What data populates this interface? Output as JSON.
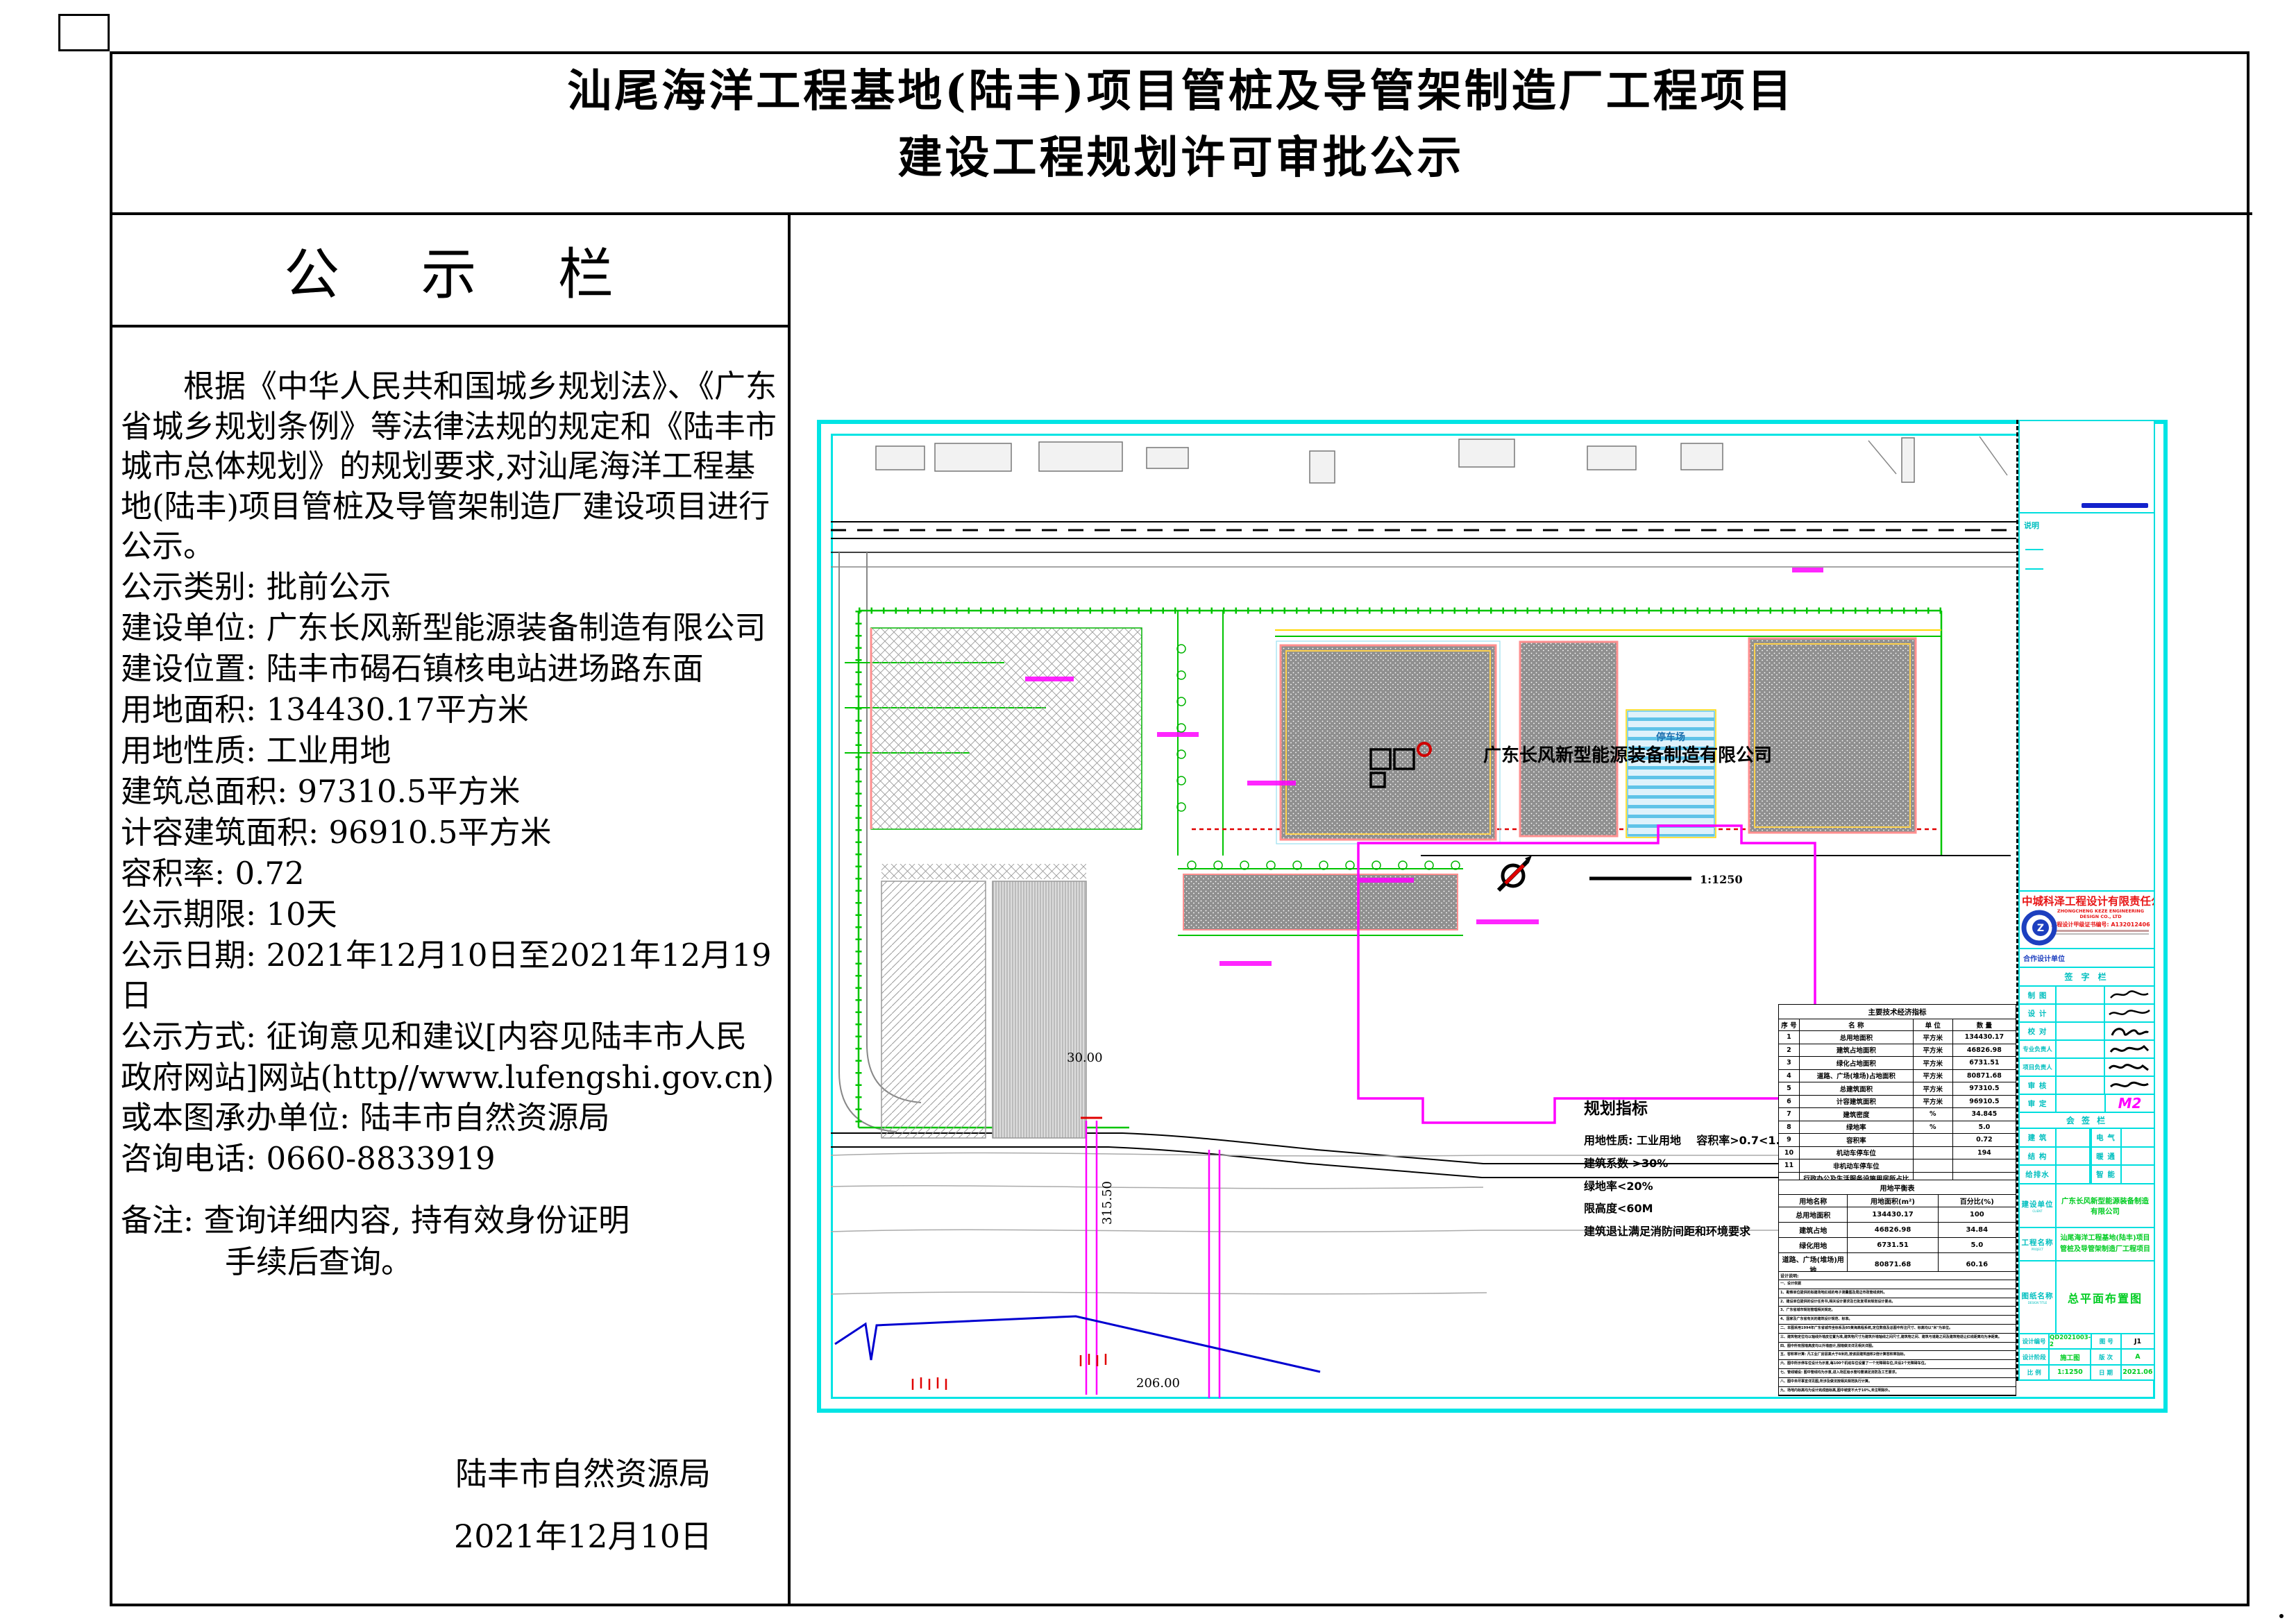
{
  "page": {
    "title_line1": "汕尾海洋工程基地(陆丰)项目管桩及导管架制造厂工程项目",
    "title_line2": "建设工程规划许可审批公示"
  },
  "notice_board": {
    "header": "公 示 栏",
    "paragraph": "根据《中华人民共和国城乡规划法》、《广东省城乡规划条例》等法律法规的规定和《陆丰市城市总体规划》的规划要求,对汕尾海洋工程基地(陆丰)项目管桩及导管架制造厂建设项目进行公示。",
    "fields": [
      "公示类别: 批前公示",
      "建设单位: 广东长风新型能源装备制造有限公司",
      "建设位置: 陆丰市碣石镇核电站进场路东面",
      "用地面积: 134430.17平方米",
      "用地性质: 工业用地",
      "建筑总面积: 97310.5平方米",
      "计容建筑面积: 96910.5平方米",
      "容积率: 0.72",
      "公示期限: 10天",
      "公示日期: 2021年12月10日至2021年12月19日",
      "公示方式: 征询意见和建议[内容见陆丰市人民政府网站]网站(http//www.lufengshi.gov.cn)或本图承办单位: 陆丰市自然资源局",
      "咨询电话:  0660-8833919"
    ],
    "remark_line1": "备注: 查询详细内容, 持有效身份证明",
    "remark_line2": "手续后查询。",
    "signature": "陆丰市自然资源局",
    "signature_date": "2021年12月10日"
  },
  "plan": {
    "owner_label": "广东长风新型能源装备制造有限公司",
    "parking_label": "停车场",
    "scale_label": "1:1250",
    "dim_width": "30.00",
    "dim_length": "315.50",
    "dim_bottom": "206.00"
  },
  "indicators": {
    "title": "规划指标",
    "lines": [
      "用地性质: 工业用地    容积率>0.7<1.5",
      "建筑系数 >30%",
      "绿地率<20%",
      "限高度<60M",
      "建筑退让满足消防间距和环境要求"
    ]
  },
  "tech_table": {
    "title": "主要技术经济指标",
    "headers": [
      "序 号",
      "名  称",
      "单 位",
      "数 量"
    ],
    "rows": [
      [
        "1",
        "总用地面积",
        "平方米",
        "134430.17"
      ],
      [
        "2",
        "建筑占地面积",
        "平方米",
        "46826.98"
      ],
      [
        "3",
        "绿化占地面积",
        "平方米",
        "6731.51"
      ],
      [
        "4",
        "道路、广场(堆场)占地面积",
        "平方米",
        "80871.68"
      ],
      [
        "5",
        "总建筑面积",
        "平方米",
        "97310.5"
      ],
      [
        "6",
        "计容建筑面积",
        "平方米",
        "96910.5"
      ],
      [
        "7",
        "建筑密度",
        "%",
        "34.845"
      ],
      [
        "8",
        "绿地率",
        "%",
        "5.0"
      ],
      [
        "9",
        "容积率",
        "",
        "0.72"
      ],
      [
        "10",
        "机动车停车位",
        "",
        "194"
      ],
      [
        "11",
        "非机动车停车位",
        "",
        ""
      ],
      [
        "12",
        "行政办公及生活服务设施用房所占比重(占总用地面积比重)",
        "%",
        "4.2"
      ]
    ]
  },
  "balance_table": {
    "title": "用地平衡表",
    "headers": [
      "用地名称",
      "用地面积(m²)",
      "百分比(%)"
    ],
    "rows": [
      [
        "总用地面积",
        "134430.17",
        "100"
      ],
      [
        "建筑占地",
        "46826.98",
        "34.84"
      ],
      [
        "绿化用地",
        "6731.51",
        "5.0"
      ],
      [
        "道路、广场(堆场)用地",
        "80871.68",
        "60.16"
      ]
    ]
  },
  "design_notes": {
    "title": "设计说明:",
    "lines": [
      "一、设计依据",
      "1、勘察单位提供的拟建场地红线的电子测量图及周边市政管线资料。",
      "2、建设单位提供的设计任务书,相关设计要求及已批复项目规划设计要点。",
      "3、广东省城市规划管理相关规定。",
      "4、国家及广东省有关的建筑设计规范、标准。",
      "二、本图采用1994年广东省城市坐标系及85黄海高程系统,定位数值及总图中所注尺寸、标高均以\"米\"为单位。",
      "三、建筑物定位均以轴线外墙皮位置为准,建筑物尺寸为建筑外墙轴线之间尺寸,建筑物之间、建筑与道路之间及建筑物退让红线距离均为净距离。",
      "四、图中所有围墙高度均以外墙面计,围墙做法详见相关详图。",
      "五、容积率计算: 凡工业厂房层高大于8米的,按该层建筑面积2倍计算容积率指标。",
      "六、图中所示停车位设计为示意,每100个机动车位设置了一个无障碍车位,共设2个无障碍车位。",
      "七、管线铺设: 图中管线均为示意,进入场区给水管均需满足消防及工艺要求。",
      "八、图中未尽事宜详见图,所涉及做法按相关规范执行计算。",
      "九、场地内标高均为设计完成面标高,图中坡度不大于10%,未注明除外。"
    ]
  },
  "titleblock": {
    "note_label": "说明",
    "company_cn": "中城科泽工程设计有限责任公司",
    "company_en": "ZHONGCHENG KEZE ENGINEERING DESIGN CO., LTD",
    "company_cert": "工程设计甲级证书编号: A132012406",
    "coop_label": "合作设计单位",
    "sign_bar": "签 字 栏",
    "sig_rows": [
      "制  图",
      "设  计",
      "校  对",
      "专业负责人",
      "项目负责人",
      "审  核",
      "审  定"
    ],
    "approval_mark": "M2",
    "countersign": "会 签 栏",
    "disciplines": [
      [
        "建 筑",
        "电 气"
      ],
      [
        "结 构",
        "暖 通"
      ],
      [
        "给排水",
        "智 能"
      ]
    ],
    "client_label": "建设单位",
    "client_sub": "CLIENT",
    "client": "广东长风新型能源装备制造有限公司",
    "project_label": "工程名称",
    "project_sub": "PROJECT",
    "project_line1": "汕尾海洋工程基地(陆丰)项目",
    "project_line2": "管桩及导管架制造厂工程项目",
    "sheet_label": "图纸名称",
    "sheet_sub": "DESIGN TITLE",
    "sheet_name": "总平面布置图",
    "grid": [
      [
        "设计编号",
        "QD2021003-2",
        "图 号",
        "J1"
      ],
      [
        "设计阶段",
        "施工图",
        "版 次",
        "A"
      ],
      [
        "比 例",
        "1:1250",
        "日 期",
        "2021.06"
      ]
    ]
  },
  "colors": {
    "frame_cyan": "#00e4e4",
    "boundary_green": "#00c400",
    "property_magenta": "#ff00ff",
    "building_outline_pink": "#ff8f8f",
    "company_red": "#e81515",
    "value_green": "#00cc22",
    "water_blue": "#0000d0"
  }
}
